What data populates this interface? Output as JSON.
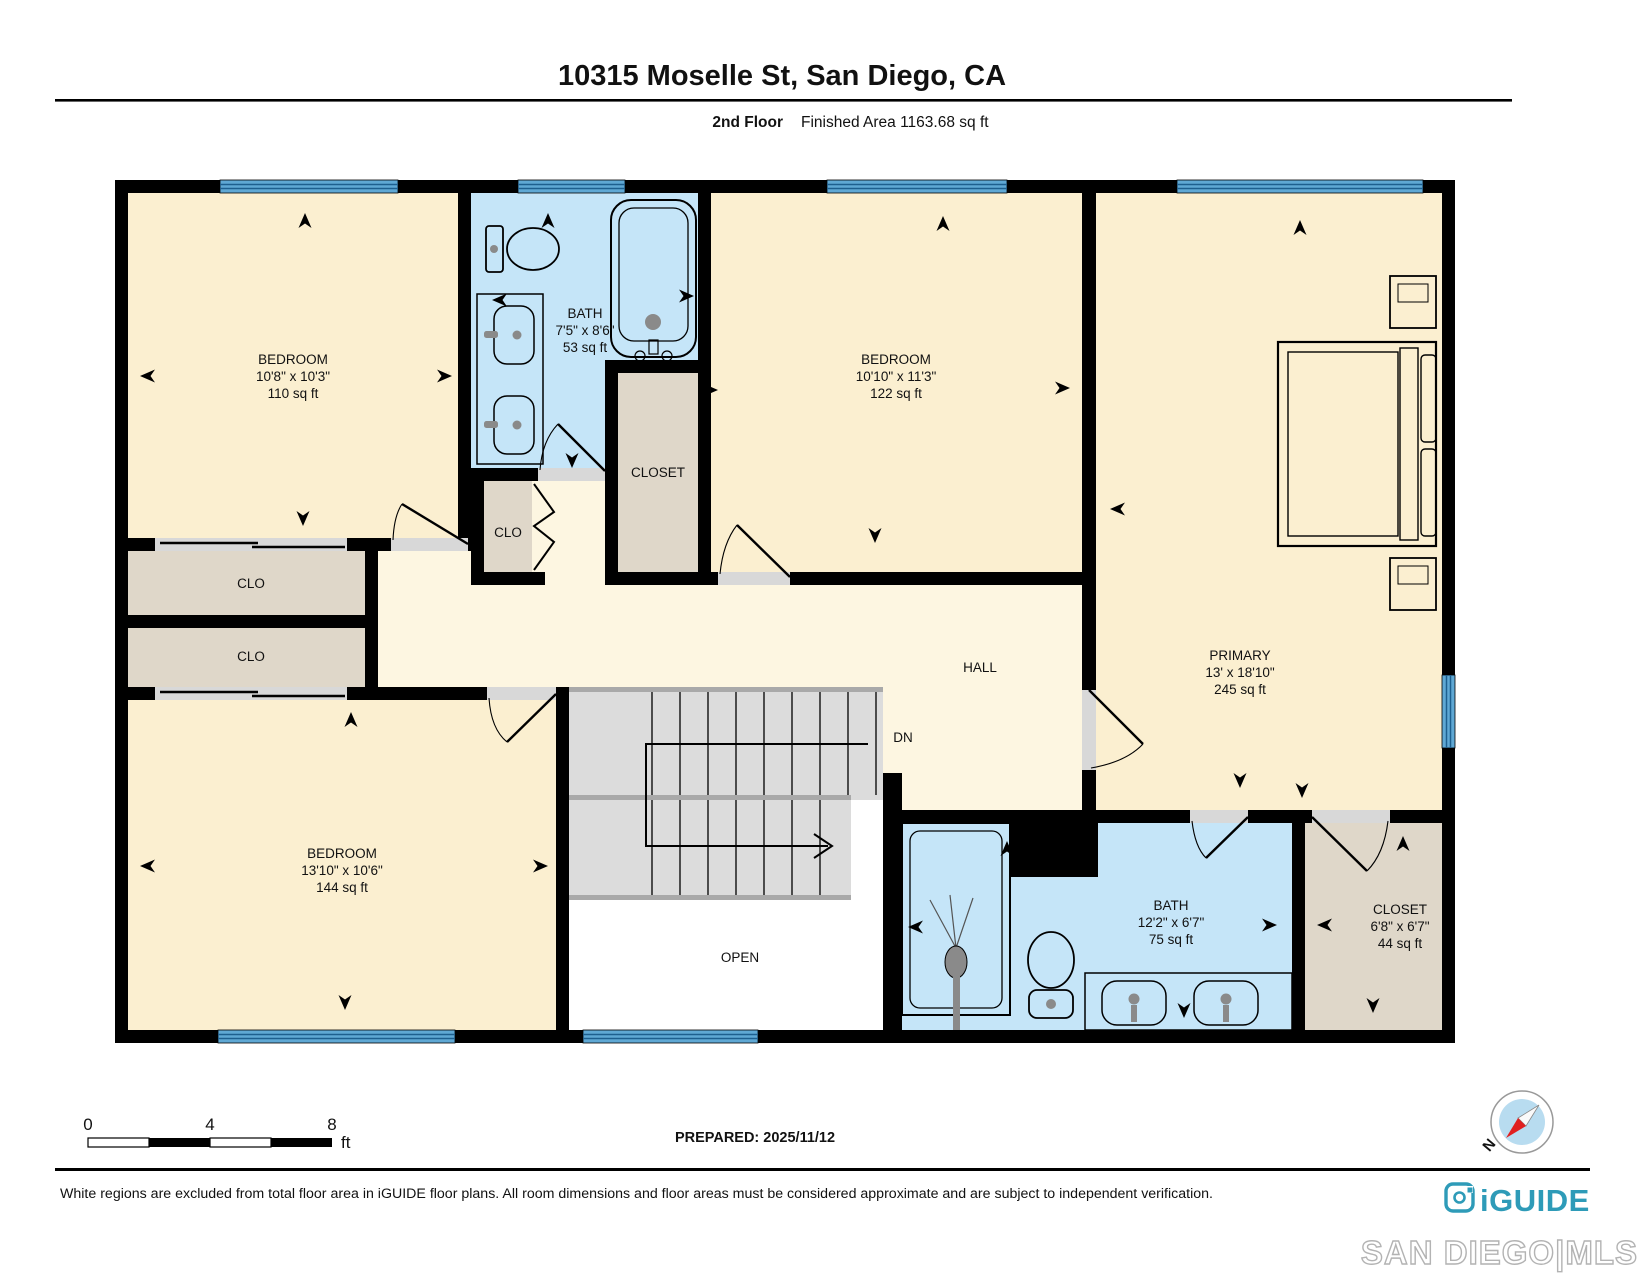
{
  "header": {
    "title": "10315 Moselle St, San Diego, CA",
    "floor_label": "2nd Floor",
    "area_label": "Finished Area 1163.68 sq ft"
  },
  "plan": {
    "rooms": {
      "bedroom1": {
        "name": "BEDROOM",
        "dims": "10'8\" x 10'3\"",
        "area": "110 sq ft"
      },
      "bath1": {
        "name": "BATH",
        "dims": "7'5\" x 8'6\"",
        "area": "53 sq ft"
      },
      "closet_mid": {
        "name": "CLOSET"
      },
      "clo_small": {
        "name": "CLO"
      },
      "bedroom2": {
        "name": "BEDROOM",
        "dims": "10'10\" x 11'3\"",
        "area": "122 sq ft"
      },
      "primary": {
        "name": "PRIMARY",
        "dims": "13' x 18'10\"",
        "area": "245 sq ft"
      },
      "clo_upper": {
        "name": "CLO"
      },
      "clo_lower": {
        "name": "CLO"
      },
      "bedroom3": {
        "name": "BEDROOM",
        "dims": "13'10\" x 10'6\"",
        "area": "144 sq ft"
      },
      "hall": {
        "name": "HALL"
      },
      "stairs": {
        "label": "DN"
      },
      "open": {
        "name": "OPEN"
      },
      "bath2": {
        "name": "BATH",
        "dims": "12'2\" x 6'7\"",
        "area": "75 sq ft"
      },
      "closet_br": {
        "name": "CLOSET",
        "dims": "6'8\" x 6'7\"",
        "area": "44 sq ft"
      }
    },
    "scale_bar": {
      "start": "0",
      "mid": "4",
      "end": "8",
      "unit": "ft"
    },
    "prepared_label": "PREPARED: 2025/11/12",
    "compass_north": "N"
  },
  "footer": {
    "disclaimer": "White regions are excluded from total floor area in iGUIDE floor plans. All room dimensions and floor areas must be considered approximate and are subject to independent verification.",
    "brand": "iGUIDE",
    "mls": "SAN DIEGO|MLS"
  },
  "colors": {
    "room_cream": "#FBEFD0",
    "hall_cream": "#FDF6E1",
    "bath_blue": "#C5E5F8",
    "closet_tan": "#DFD7C9",
    "window_blue": "#5FA8D4",
    "stair_gray": "#DCDCDC",
    "brand_teal": "#2E9BB8"
  }
}
